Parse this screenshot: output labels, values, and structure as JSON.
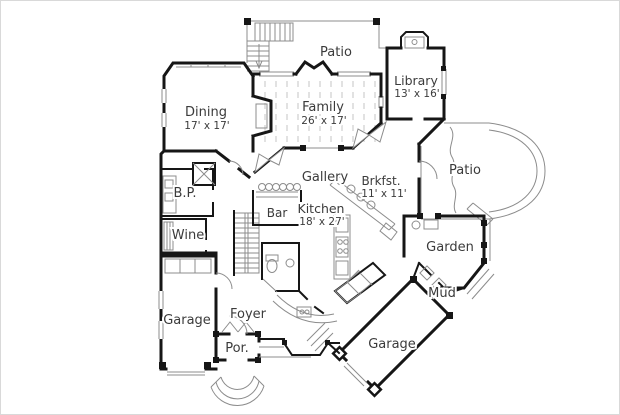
{
  "palette": {
    "background": "#ffffff",
    "frame_border": "#d9d9d9",
    "wall": "#161616",
    "thin_line": "#8c8c8c",
    "floor_hatch": "#c6c6c6",
    "label_text": "#3b3b3b"
  },
  "rooms": [
    {
      "id": "patio-rear",
      "label": "Patio",
      "dims": ""
    },
    {
      "id": "library",
      "label": "Library",
      "dims": "13' x 16'"
    },
    {
      "id": "dining",
      "label": "Dining",
      "dims": "17' x 17'"
    },
    {
      "id": "family",
      "label": "Family",
      "dims": "26' x 17'"
    },
    {
      "id": "patio-side",
      "label": "Patio",
      "dims": ""
    },
    {
      "id": "gallery",
      "label": "Gallery",
      "dims": ""
    },
    {
      "id": "brkfst",
      "label": "Brkfst.",
      "dims": "11' x 11'"
    },
    {
      "id": "butlers-pantry",
      "label": "B.P.",
      "dims": ""
    },
    {
      "id": "bar",
      "label": "Bar",
      "dims": ""
    },
    {
      "id": "kitchen",
      "label": "Kitchen",
      "dims": "18' x 27'"
    },
    {
      "id": "wine",
      "label": "Wine",
      "dims": ""
    },
    {
      "id": "garden",
      "label": "Garden",
      "dims": ""
    },
    {
      "id": "garage-left",
      "label": "Garage",
      "dims": ""
    },
    {
      "id": "foyer",
      "label": "Foyer",
      "dims": ""
    },
    {
      "id": "mud",
      "label": "Mud",
      "dims": ""
    },
    {
      "id": "porch",
      "label": "Por.",
      "dims": ""
    },
    {
      "id": "garage-rear",
      "label": "Garage",
      "dims": ""
    }
  ]
}
